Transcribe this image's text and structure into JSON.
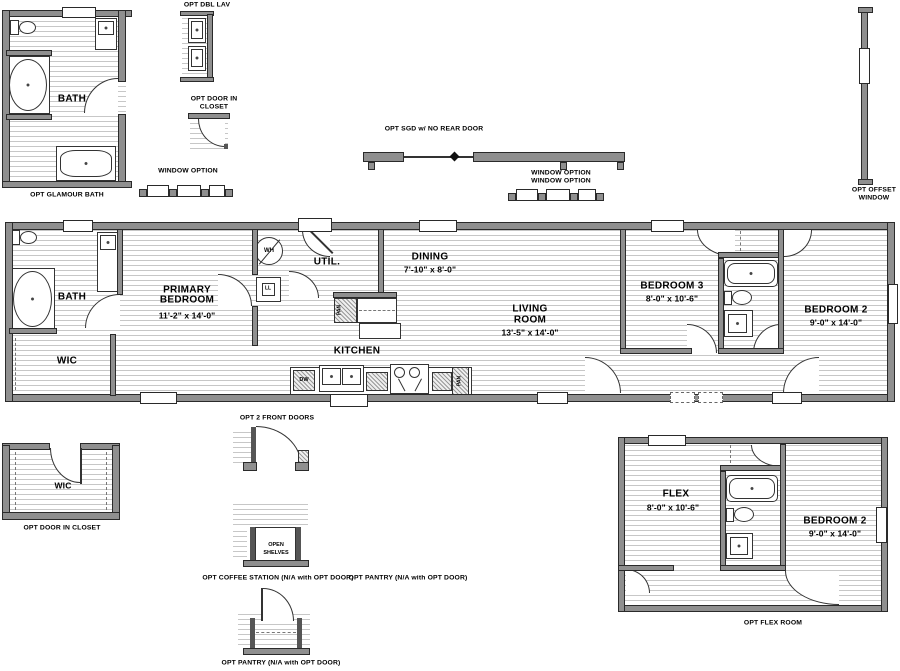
{
  "colors": {
    "wall": "#8f8f8f",
    "wall_edge": "#2a2a2a",
    "floor_line": "#c7c7c7",
    "text": "#000000"
  },
  "top_options": {
    "glamour_bath": {
      "caption": "OPT GLAMOUR BATH",
      "room": "BATH"
    },
    "dbl_lav": {
      "caption": "OPT DBL LAV"
    },
    "door_in_closet": {
      "line1": "OPT DOOR IN",
      "line2": "CLOSET"
    },
    "window_left": {
      "caption": "WINDOW OPTION"
    },
    "sgd": {
      "caption": "OPT SGD w/ NO REAR DOOR"
    },
    "window_mid": {
      "line1": "WINDOW OPTION",
      "line2": "WINDOW OPTION"
    },
    "offset_window": {
      "line1": "OPT OFFSET",
      "line2": "WINDOW"
    }
  },
  "main_plan": {
    "bath": "BATH",
    "wic": "WIC",
    "primary_line1": "PRIMARY",
    "primary_line2": "BEDROOM",
    "primary_dims": "11'-2\" x 14'-0\"",
    "util": "UTIL.",
    "dining": "DINING",
    "dining_dims": "7'-10\" x 8'-0\"",
    "kitchen": "KITCHEN",
    "living_line1": "LIVING",
    "living_line2": "ROOM",
    "living_dims": "13'-5\" x 14'-0\"",
    "bedroom3": "BEDROOM 3",
    "bedroom3_dims": "8'-0\" x 10'-6\"",
    "bedroom2": "BEDROOM 2",
    "bedroom2_dims": "9'-0\" x 14'-0\"",
    "wh": "WH",
    "ll": "LL",
    "dw": "DW",
    "pan_upper": "PAN",
    "pan_lower": "PAN"
  },
  "bottom_options": {
    "wic_room": "WIC",
    "wic_caption": "OPT DOOR IN CLOSET",
    "front_doors_caption": "OPT 2 FRONT DOORS",
    "shelves_line1": "OPEN",
    "shelves_line2": "SHELVES",
    "coffee_caption": "OPT COFFEE STATION (N/A with OPT DOOR)",
    "pantry_caption_right": "OPT PANTRY (N/A with OPT DOOR)",
    "pantry_caption_bottom": "OPT PANTRY (N/A with OPT DOOR)",
    "flex": {
      "name": "FLEX",
      "dims": "8'-0\" x 10'-6\"",
      "bedroom2": "BEDROOM 2",
      "bedroom2_dims": "9'-0\" x 14'-0\"",
      "caption": "OPT FLEX ROOM"
    }
  }
}
